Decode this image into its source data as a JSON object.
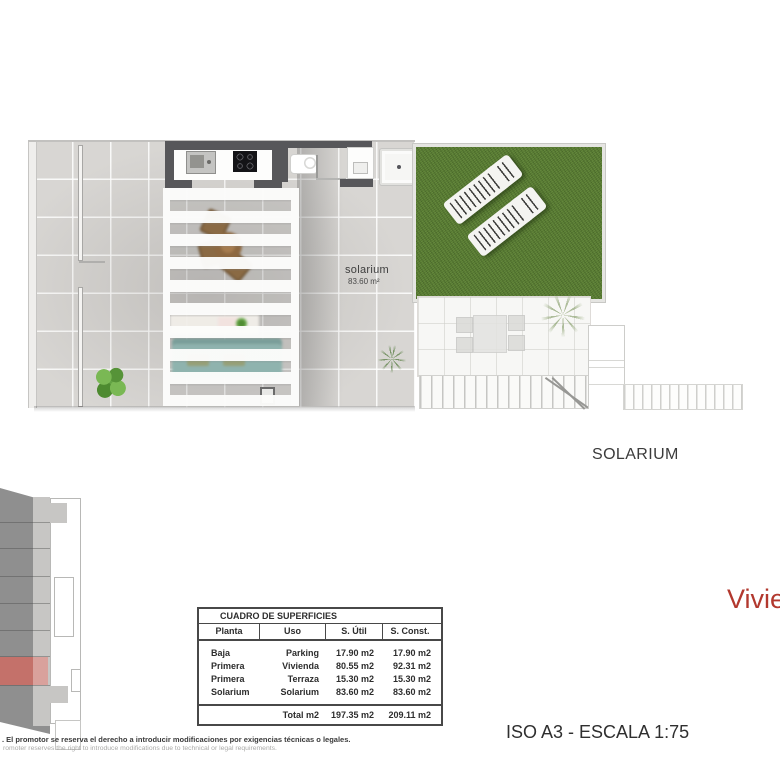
{
  "titles": {
    "floor_name": "SOLARIUM",
    "unit_name": "Vivienda",
    "scale_label": "ISO A3 - ESCALA 1:75"
  },
  "plan": {
    "area_label": "solarium",
    "area_value": "83.60 m²"
  },
  "surfaces_table": {
    "title": "CUADRO DE SUPERFICIES",
    "columns": [
      "Planta",
      "Uso",
      "S. Útil",
      "S. Const."
    ],
    "rows": [
      {
        "planta": "Baja",
        "uso": "Parking",
        "util": "17.90 m2",
        "construida": "17.90 m2"
      },
      {
        "planta": "Primera",
        "uso": "Vivienda",
        "util": "80.55 m2",
        "construida": "92.31 m2"
      },
      {
        "planta": "Primera",
        "uso": "Terraza",
        "util": "15.30 m2",
        "construida": "15.30 m2"
      },
      {
        "planta": "Solarium",
        "uso": "Solarium",
        "util": "83.60 m2",
        "construida": "83.60 m2"
      }
    ],
    "total": {
      "label": "Total m2",
      "util": "197.35 m2",
      "construida": "209.11 m2"
    }
  },
  "footer": {
    "disclaimer_es": ". El promotor se reserva el derecho a introducir modificaciones por exigencias técnicas o legales.",
    "disclaimer_en": "romoter reserves the right to introduce modifications due to technical or legal requirements."
  },
  "colors": {
    "accent_red": "#b2382e",
    "grass_green": "#567a30",
    "keyplan_highlight": "#c4716a"
  }
}
